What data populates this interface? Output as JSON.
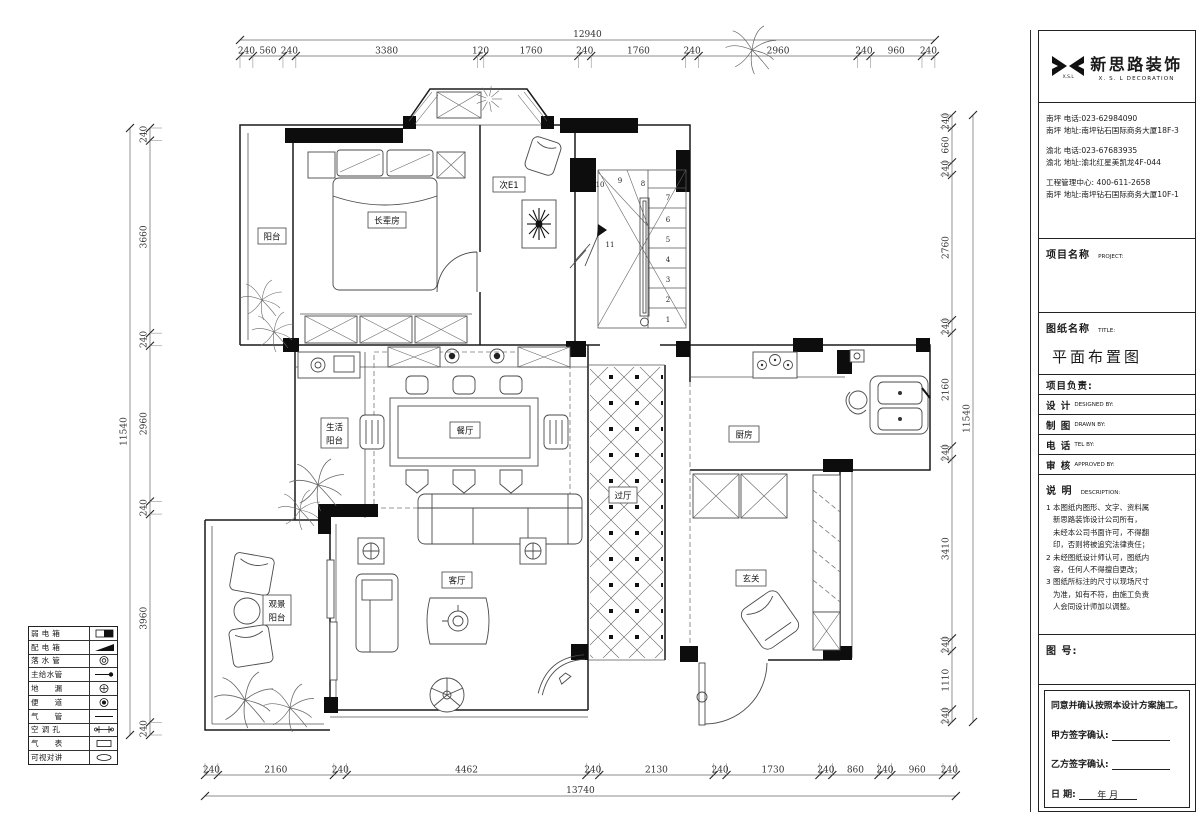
{
  "company": {
    "logo_symbol": "xsl-bowtie-logo",
    "logo_caption": "X.S.L",
    "name_cn": "新思路装饰",
    "name_en": "X. S. L  DECORATION",
    "contacts": [
      {
        "lines": [
          "南坪  电话:023-62984090",
          "南坪  地址:南坪钻石国际商务大厦18F-3"
        ]
      },
      {
        "lines": [
          "渝北  电话:023-67683935",
          "渝北  地址:渝北红星美凯龙4F-044"
        ]
      },
      {
        "lines": [
          "工程管理中心: 400-611-2658",
          "南坪  地址:南坪钻石国际商务大厦10F-1"
        ]
      }
    ]
  },
  "title_block": {
    "project_label": "项目名称",
    "project_label_en": "PROJECT:",
    "drawing_label": "图纸名称",
    "drawing_label_en": "TITLE:",
    "drawing_title": "平面布置图",
    "leader_label": "项目负责:",
    "rows": [
      {
        "cn": "设  计",
        "en": "DESIGNED BY:"
      },
      {
        "cn": "制  图",
        "en": "DRAWN BY:"
      },
      {
        "cn": "电  话",
        "en": "TEL BY:"
      },
      {
        "cn": "审  核",
        "en": "APPROVED BY:"
      }
    ],
    "notes_label": "说  明",
    "notes_label_en": "DESCRIPTION:",
    "notes": [
      "1 本图纸内图形、文字、资料属",
      "新思路装饰设计公司所有，",
      "未经本公司书面许可，不得翻",
      "印，否则将被追究法律责任；",
      "2 未经图纸设计师认可，图纸内",
      "容，任何人不得擅自更改；",
      "3 图纸所标注的尺寸以现场尺寸",
      "为准，如有不符，由施工负责",
      "人会同设计师加以调整。"
    ],
    "figure_no_label": "图 号:",
    "confirm": {
      "statement": "同意并确认按照本设计方案施工。",
      "party_a": "甲方签字确认:",
      "party_b": "乙方签字确认:",
      "date_label": "日        期:",
      "date_suffix": "年    月"
    }
  },
  "dimensions": {
    "top": {
      "total": "12940",
      "segments": [
        "240",
        "560",
        "240",
        "3380",
        "120",
        "1760",
        "240",
        "1760",
        "240",
        "2960",
        "240",
        "960",
        "240"
      ]
    },
    "bottom": {
      "total": "13740",
      "segments": [
        "240",
        "2160",
        "240",
        "4462",
        "240",
        "2130",
        "240",
        "1730",
        "240",
        "860",
        "240",
        "960",
        "240"
      ]
    },
    "left": {
      "total": "11540",
      "segments": [
        "240",
        "3660",
        "240",
        "2960",
        "240",
        "3960",
        "240"
      ]
    },
    "right": {
      "total": "11540",
      "segments": [
        "240",
        "660",
        "240",
        "2760",
        "240",
        "2160",
        "240",
        "3410",
        "240",
        "1110",
        "240"
      ]
    }
  },
  "rooms": [
    {
      "id": "balcony-n",
      "label": "阳台"
    },
    {
      "id": "elder-bedroom",
      "label": "长辈房"
    },
    {
      "id": "bedroom-e1",
      "label": "次E1"
    },
    {
      "id": "service-balcony",
      "label_lines": [
        "生活",
        "阳台"
      ]
    },
    {
      "id": "dining",
      "label": "餐厅"
    },
    {
      "id": "kitchen",
      "label": "厨房"
    },
    {
      "id": "hall",
      "label": "过厅"
    },
    {
      "id": "living",
      "label": "客厅"
    },
    {
      "id": "entry",
      "label": "玄关"
    },
    {
      "id": "view-balcony",
      "label_lines": [
        "观景",
        "阳台"
      ]
    }
  ],
  "stairs": {
    "numbers": [
      "1",
      "2",
      "3",
      "4",
      "5",
      "6",
      "7",
      "8",
      "9",
      "10",
      "11"
    ]
  },
  "legend": {
    "rows": [
      {
        "label": "弱 电 箱",
        "symbol": "weak-current-box"
      },
      {
        "label": "配 电 箱",
        "symbol": "distribution-box"
      },
      {
        "label": "落 水 管",
        "symbol": "downpipe"
      },
      {
        "label": "主给水管",
        "symbol": "main-water-pipe"
      },
      {
        "label": "地　　漏",
        "symbol": "floor-drain"
      },
      {
        "label": "便　　道",
        "symbol": "toilet-drain"
      },
      {
        "label": "气　　管",
        "symbol": "gas-pipe"
      },
      {
        "label": "空 调 孔",
        "symbol": "ac-hole"
      },
      {
        "label": "气　　表",
        "symbol": "gas-meter"
      },
      {
        "label": "可视对讲",
        "symbol": "video-intercom"
      }
    ]
  },
  "colors": {
    "line": "#1a1a1a",
    "pier": "#0d0d0d",
    "dim_text": "#333333"
  }
}
